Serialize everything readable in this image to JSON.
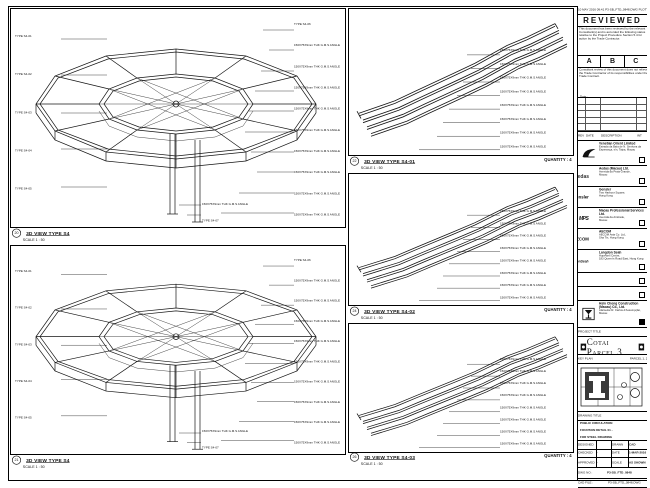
{
  "sheet": {
    "plot_stamp": "10 MAY 2016 09:41  P3-SB_FTD_0848.DWG  PLOTTED BY: CAD"
  },
  "panels": {
    "tl": {
      "bubble": "20",
      "title": "3D VIEW TYPE S4",
      "scale": "SCALE 1 : 50",
      "left_labels": [
        "TYPE S4-01",
        "TYPE S4-02",
        "TYPE S4-03",
        "TYPE S4-04",
        "TYPE S4-05"
      ],
      "right_labels": [
        "TYPE S4-06",
        "150X75X9mm THK G.M.S ANGLE",
        "150X75X9mm THK G.M.S ANGLE",
        "150X75X9mm THK G.M.S ANGLE",
        "150X75X9mm THK G.M.S ANGLE",
        "150X75X9mm THK G.M.S ANGLE",
        "150X75X9mm THK G.M.S ANGLE",
        "150X75X9mm THK G.M.S ANGLE",
        "150X75X9mm THK G.M.S ANGLE",
        "150X75X9mm THK G.M.S ANGLE"
      ],
      "bottom_labels": [
        "150X75X9mm THK G.M.S ANGLE",
        "TYPE S4-07"
      ]
    },
    "bl": {
      "bubble": "21",
      "title": "3D VIEW TYPE S4",
      "scale": "SCALE 1 : 50",
      "left_labels": [
        "TYPE S4-01",
        "TYPE S4-02",
        "TYPE S4-03",
        "TYPE S4-04",
        "TYPE S4-05"
      ],
      "right_labels": [
        "TYPE S4-06",
        "150X75X9mm THK G.M.S ANGLE",
        "150X75X9mm THK G.M.S ANGLE",
        "150X75X9mm THK G.M.S ANGLE",
        "150X75X9mm THK G.M.S ANGLE",
        "150X75X9mm THK G.M.S ANGLE",
        "150X75X9mm THK G.M.S ANGLE",
        "150X75X9mm THK G.M.S ANGLE",
        "150X75X9mm THK G.M.S ANGLE",
        "150X75X9mm THK G.M.S ANGLE"
      ],
      "bottom_labels": [
        "150X75X9mm THK G.M.S ANGLE",
        "TYPE S4-07"
      ]
    },
    "m1": {
      "bubble": "22",
      "title": "3D VIEW TYPE S4-01",
      "scale": "SCALE 1 : 50",
      "quantity": "QUANTITY : 4",
      "labels": [
        "150X75X9mm THK G.M.S ANGLE",
        "150X75X9mm THK G.M.S ANGLE",
        "150X75X9mm THK G.M.S ANGLE",
        "150X75X9mm THK G.M.S ANGLE",
        "150X75X9mm THK G.M.S ANGLE",
        "150X75X9mm THK G.M.S ANGLE",
        "150X75X9mm THK G.M.S ANGLE",
        "150X75X9mm THK G.M.S ANGLE"
      ]
    },
    "m2": {
      "bubble": "24",
      "title": "3D VIEW TYPE S4-02",
      "scale": "SCALE 1 : 50",
      "quantity": "QUANTITY : 4",
      "labels": [
        "150X75X9mm THK G.M.S ANGLE",
        "150X75X9mm THK G.M.S ANGLE",
        "150X75X9mm THK G.M.S ANGLE",
        "150X75X9mm THK G.M.S ANGLE",
        "150X75X9mm THK G.M.S ANGLE",
        "150X75X9mm THK G.M.S ANGLE",
        "150X75X9mm THK G.M.S ANGLE",
        "150X75X9mm THK G.M.S ANGLE"
      ]
    },
    "m3": {
      "bubble": "26",
      "title": "3D VIEW TYPE S4-03",
      "scale": "SCALE 1 : 50",
      "quantity": "QUANTITY : 4",
      "labels": [
        "150X75X9mm THK G.M.S ANGLE",
        "150X75X9mm THK G.M.S ANGLE",
        "150X75X9mm THK G.M.S ANGLE",
        "150X75X9mm THK G.M.S ANGLE",
        "150X75X9mm THK G.M.S ANGLE",
        "150X75X9mm THK G.M.S ANGLE",
        "150X75X9mm THK G.M.S ANGLE",
        "150X75X9mm THK G.M.S ANGLE"
      ]
    }
  },
  "titleblock": {
    "reviewed": {
      "title": "REVIEWED",
      "para1": "This document has been reviewed by the relevant Consultant(s) and is accorded the following status relative to the Project Procedure Section 5.4 for action by the Trade Contractor.",
      "statuses": [
        "A",
        "B",
        "C"
      ],
      "para2": "Consultant review of this document does not relieve the Trade Contractor of its responsibilities under the Trade Contract.",
      "date_label": "Date :"
    },
    "rev_headers": [
      "REV",
      "DATE",
      "DESCRIPTION",
      "INT"
    ],
    "consultants": [
      {
        "name": "Venetian Orient Limited",
        "address": "Estrada da Baía de N. Senhora da\nEsperança, s/n, Taipa, Macau"
      },
      {
        "logo_text": "Aedas",
        "name": "Aedas (Macau) Ltd.",
        "address": "Avenida da Praia Grande,\nMacau"
      },
      {
        "logo_text": "Gensler",
        "name": "Gensler",
        "address": "Two Harbour Square,\nHong Kong"
      },
      {
        "logo_text": "MPS",
        "name": "Macau Professional Services Ltd.",
        "address": "Avenida da Amizade,\nMacau"
      },
      {
        "logo_text": "AECOM",
        "name": "AECOM",
        "address": "AECOM Asia Co. Ltd.,\nSha Tin, Hong Kong"
      },
      {
        "logo_text": "LangdonSeah",
        "name": "Langdon Seah",
        "address": "Hopewell Centre,\n183 Queen's Road East, Hong Kong"
      },
      {
        "name": "Hsin Chong Construction\n(Macau) Co., Ltd.",
        "address": "Alameda Dr. Carlos d'Assumpção,\nMacau"
      }
    ],
    "project_label": "PROJECT TITLE",
    "project_name": "Cotai Parcel 3",
    "keyplan_label": "KEY PLAN",
    "keyplan_right": "PARCEL 1, 2 & 3",
    "drawing_title_label": "DRAWING TITLE",
    "drawing_title_lines": [
      "PUBLIC CIRCULATION",
      "FOUNTAIN DETAIL 01 -",
      "FOR STEEL DRAWING"
    ],
    "info": {
      "designed_label": "DESIGNED",
      "designed": "",
      "drawn_label": "DRAWN",
      "drawn": "CAD",
      "checked_label": "CHECKED",
      "checked": "-",
      "date_label": "DATE",
      "date": "1-MAR-2016",
      "approved_label": "APPROVED",
      "approved": "-",
      "scale_label": "SCALE",
      "scale": "AS SHOWN"
    },
    "dwg_label": "DWG NO :",
    "dwg_no": "P3-SB_FTD_0848",
    "rev_label": "REV :",
    "rev": "A",
    "cad_label": "CAD FILE :",
    "cad_file": "P3-SB_FTD_0848.DWG",
    "note": "DO NOT SCALE THIS DRAWING"
  }
}
